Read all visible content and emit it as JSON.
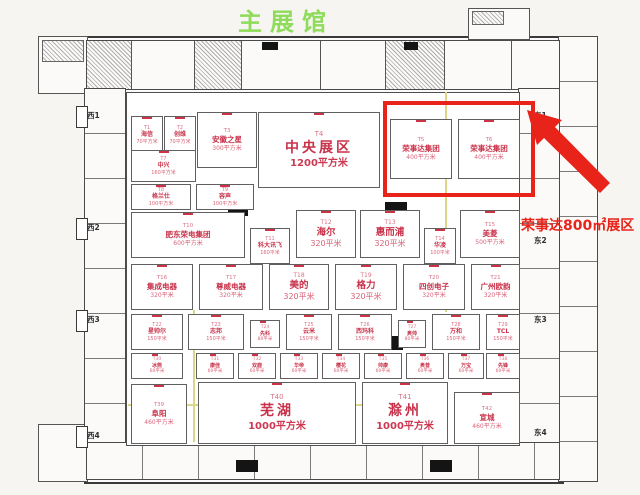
{
  "title": {
    "text": "主展馆"
  },
  "annotation": {
    "text": "荣事达800㎡展区"
  },
  "colors": {
    "title_green": "#8fdb5a",
    "accent_red": "#e8231a",
    "booth_text": "#c8324a"
  },
  "doors": {
    "west": [
      {
        "label": "西1",
        "y": 110
      },
      {
        "label": "西2",
        "y": 222
      },
      {
        "label": "西3",
        "y": 314
      },
      {
        "label": "西4",
        "y": 430
      }
    ],
    "east": [
      {
        "label": "东1",
        "y": 110
      },
      {
        "label": "东2",
        "y": 235
      },
      {
        "label": "东3",
        "y": 314
      },
      {
        "label": "东4",
        "y": 427
      }
    ]
  },
  "highlight": {
    "x": 383,
    "y": 101,
    "w": 144,
    "h": 88
  },
  "booths": [
    {
      "id": "T1",
      "name": "海信",
      "area": "70平方米",
      "x": 131,
      "y": 116,
      "w": 30,
      "h": 36,
      "size": "xs"
    },
    {
      "id": "T2",
      "name": "创维",
      "area": "70平方米",
      "x": 164,
      "y": 116,
      "w": 30,
      "h": 36,
      "size": "xs"
    },
    {
      "id": "T3",
      "name": "安徽之星",
      "area": "300平方米",
      "x": 197,
      "y": 112,
      "w": 58,
      "h": 54,
      "size": "sm"
    },
    {
      "id": "T4",
      "name": "中央展区",
      "area": "1200平方米",
      "x": 258,
      "y": 112,
      "w": 120,
      "h": 74,
      "size": "lg"
    },
    {
      "id": "T5",
      "name": "荣事达集团",
      "area": "400平方米",
      "x": 390,
      "y": 119,
      "w": 60,
      "h": 58,
      "size": "sm"
    },
    {
      "id": "T6",
      "name": "荣事达集团",
      "area": "400平方米",
      "x": 458,
      "y": 119,
      "w": 60,
      "h": 58,
      "size": "sm"
    },
    {
      "id": "T7",
      "name": "中兴",
      "area": "160平方米",
      "x": 131,
      "y": 150,
      "w": 63,
      "h": 30,
      "size": "xs"
    },
    {
      "id": "T8",
      "name": "格兰仕",
      "area": "100平方米",
      "x": 131,
      "y": 184,
      "w": 58,
      "h": 24,
      "size": "xs"
    },
    {
      "id": "T9",
      "name": "容声",
      "area": "100平方米",
      "x": 196,
      "y": 184,
      "w": 56,
      "h": 24,
      "size": "xs"
    },
    {
      "id": "T10",
      "name": "肥东荣电集团",
      "area": "600平方米",
      "x": 131,
      "y": 212,
      "w": 112,
      "h": 44,
      "size": "sm"
    },
    {
      "id": "T11",
      "name": "科大讯飞",
      "area": "160平米",
      "x": 250,
      "y": 228,
      "w": 38,
      "h": 34,
      "size": "xs"
    },
    {
      "id": "T12",
      "name": "海尔",
      "area": "320平米",
      "x": 296,
      "y": 210,
      "w": 58,
      "h": 46,
      "size": "md"
    },
    {
      "id": "T13",
      "name": "惠而浦",
      "area": "320平米",
      "x": 360,
      "y": 210,
      "w": 58,
      "h": 46,
      "size": "md"
    },
    {
      "id": "T14",
      "name": "华凌",
      "area": "100平米",
      "x": 424,
      "y": 228,
      "w": 30,
      "h": 34,
      "size": "xs"
    },
    {
      "id": "T15",
      "name": "美菱",
      "area": "500平方米",
      "x": 460,
      "y": 210,
      "w": 58,
      "h": 46,
      "size": "sm"
    },
    {
      "id": "T16",
      "name": "集成电器",
      "area": "320平米",
      "x": 131,
      "y": 264,
      "w": 60,
      "h": 44,
      "size": "sm"
    },
    {
      "id": "T17",
      "name": "尊威电器",
      "area": "320平米",
      "x": 199,
      "y": 264,
      "w": 62,
      "h": 44,
      "size": "sm"
    },
    {
      "id": "T18",
      "name": "美的",
      "area": "320平米",
      "x": 269,
      "y": 264,
      "w": 58,
      "h": 44,
      "size": "md"
    },
    {
      "id": "T19",
      "name": "格力",
      "area": "320平米",
      "x": 335,
      "y": 264,
      "w": 60,
      "h": 44,
      "size": "md"
    },
    {
      "id": "T20",
      "name": "四创电子",
      "area": "320平米",
      "x": 403,
      "y": 264,
      "w": 60,
      "h": 44,
      "size": "sm"
    },
    {
      "id": "T21",
      "name": "广州欧韵",
      "area": "320平米",
      "x": 471,
      "y": 264,
      "w": 47,
      "h": 44,
      "size": "sm"
    },
    {
      "id": "T22",
      "name": "星帅尔",
      "area": "150平米",
      "x": 131,
      "y": 314,
      "w": 50,
      "h": 34,
      "size": "xs"
    },
    {
      "id": "T23",
      "name": "志邦",
      "area": "150平米",
      "x": 188,
      "y": 314,
      "w": 54,
      "h": 34,
      "size": "xs"
    },
    {
      "id": "T24",
      "name": "先科",
      "area": "80平米",
      "x": 250,
      "y": 320,
      "w": 28,
      "h": 26,
      "size": "xxs"
    },
    {
      "id": "T25",
      "name": "云米",
      "area": "150平米",
      "x": 286,
      "y": 314,
      "w": 44,
      "h": 34,
      "size": "xs"
    },
    {
      "id": "T26",
      "name": "西玛科",
      "area": "150平米",
      "x": 338,
      "y": 314,
      "w": 52,
      "h": 34,
      "size": "xs"
    },
    {
      "id": "T27",
      "name": "奥帅",
      "area": "80平米",
      "x": 398,
      "y": 320,
      "w": 26,
      "h": 26,
      "size": "xxs"
    },
    {
      "id": "T28",
      "name": "万和",
      "area": "150平米",
      "x": 432,
      "y": 314,
      "w": 46,
      "h": 34,
      "size": "xs"
    },
    {
      "id": "T29",
      "name": "TCL",
      "area": "150平米",
      "x": 486,
      "y": 314,
      "w": 32,
      "h": 34,
      "size": "xs"
    },
    {
      "id": "T30",
      "name": "冰熊",
      "area": "60平米",
      "x": 131,
      "y": 353,
      "w": 50,
      "h": 24,
      "size": "xxs"
    },
    {
      "id": "T31",
      "name": "康佳",
      "area": "60平米",
      "x": 196,
      "y": 353,
      "w": 36,
      "h": 24,
      "size": "xxs"
    },
    {
      "id": "T32",
      "name": "双鹿",
      "area": "60平米",
      "x": 238,
      "y": 353,
      "w": 36,
      "h": 24,
      "size": "xxs"
    },
    {
      "id": "T33",
      "name": "华帝",
      "area": "60平米",
      "x": 280,
      "y": 353,
      "w": 36,
      "h": 24,
      "size": "xxs"
    },
    {
      "id": "T34",
      "name": "樱花",
      "area": "60平米",
      "x": 322,
      "y": 353,
      "w": 36,
      "h": 24,
      "size": "xxs"
    },
    {
      "id": "T35",
      "name": "帅康",
      "area": "60平米",
      "x": 364,
      "y": 353,
      "w": 36,
      "h": 24,
      "size": "xxs"
    },
    {
      "id": "T36",
      "name": "奥普",
      "area": "60平米",
      "x": 406,
      "y": 353,
      "w": 36,
      "h": 24,
      "size": "xxs"
    },
    {
      "id": "T37",
      "name": "万宝",
      "area": "60平米",
      "x": 448,
      "y": 353,
      "w": 34,
      "h": 24,
      "size": "xxs"
    },
    {
      "id": "T38",
      "name": "先锋",
      "area": "60平米",
      "x": 486,
      "y": 353,
      "w": 32,
      "h": 24,
      "size": "xxs"
    },
    {
      "id": "T39",
      "name": "阜阳",
      "area": "460平方米",
      "x": 131,
      "y": 384,
      "w": 54,
      "h": 58,
      "size": "sm"
    },
    {
      "id": "T40",
      "name": "芜湖",
      "area": "1000平方米",
      "x": 198,
      "y": 382,
      "w": 156,
      "h": 60,
      "size": "lg"
    },
    {
      "id": "T41",
      "name": "滁州",
      "area": "1000平方米",
      "x": 362,
      "y": 382,
      "w": 84,
      "h": 60,
      "size": "lg"
    },
    {
      "id": "T42",
      "name": "宣城",
      "area": "460平方米",
      "x": 454,
      "y": 392,
      "w": 64,
      "h": 50,
      "size": "sm"
    }
  ]
}
